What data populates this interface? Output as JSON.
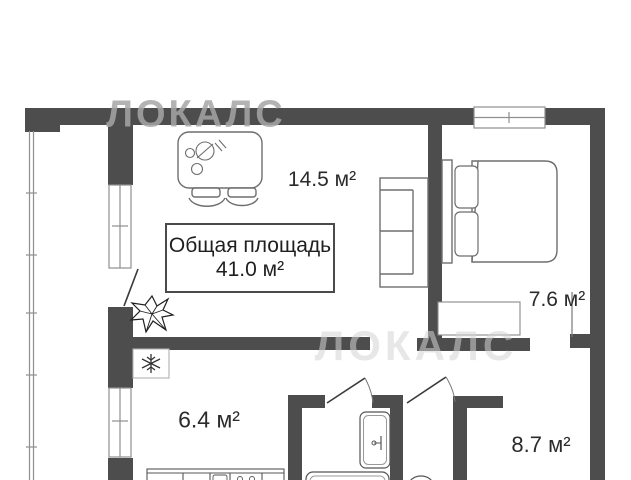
{
  "watermark": {
    "top": "ЛОКАЛС",
    "middle": "ЛОКАЛС"
  },
  "total_area_box": {
    "title": "Общая площадь",
    "value": "41.0 м²"
  },
  "room_labels": {
    "living_room": "14.5 м²",
    "bedroom": "7.6 м²",
    "kitchen": "6.4 м²",
    "hallway": "8.7 м²"
  },
  "colors": {
    "wall": "#4d4d4d",
    "furniture_line": "#6e6e6e",
    "thin_line": "#8f8f8f",
    "label_text": "#2b2b2b",
    "watermark_top": "rgba(166,166,166,0.85)",
    "watermark_middle": "rgba(212,212,212,0.55)",
    "background": "#ffffff"
  },
  "icons": {
    "fridge": "snowflake-icon",
    "plant": "plant-icon"
  }
}
